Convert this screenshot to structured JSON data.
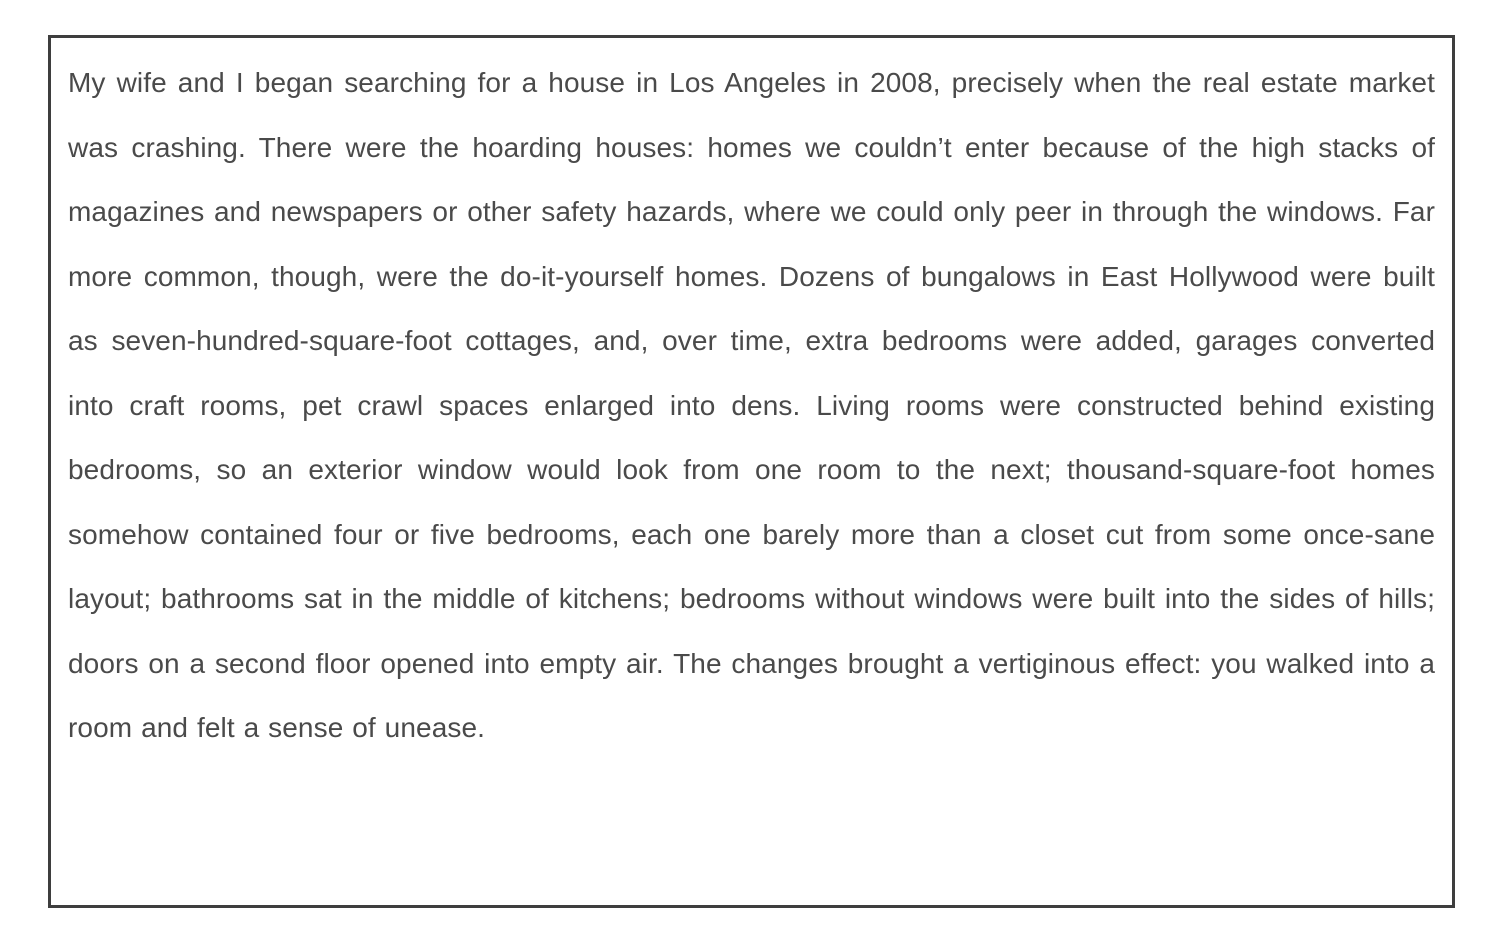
{
  "page": {
    "background_color": "#ffffff"
  },
  "frame": {
    "border_color": "#3e3e3e",
    "background_color": "#ffffff",
    "text_color": "#4a4a4a"
  },
  "passage": {
    "text": "My wife and I began searching for a house in Los Angeles in 2008, precisely when the real estate market was crashing. There were the hoarding houses: homes we couldn’t enter because of the high stacks of magazines and newspapers or other safety hazards, where we could only peer in through the windows. Far more common, though, were the do-it-yourself homes. Dozens of bungalows in East Hollywood were built as seven-hundred-square-foot cottages, and, over time, extra bedrooms were added, garages converted into craft rooms, pet crawl spaces enlarged into dens. Living rooms were constructed behind existing bedrooms, so an exterior window would look from one room to the next; thousand-square-foot homes somehow contained four or five bedrooms, each one barely more than a closet cut from some once-sane layout; bathrooms sat in the middle of kitchens; bedrooms without windows were built into the sides of hills; doors on a second floor opened into empty air. The changes brought a vertiginous effect: you walked into a room and felt a sense of unease."
  }
}
